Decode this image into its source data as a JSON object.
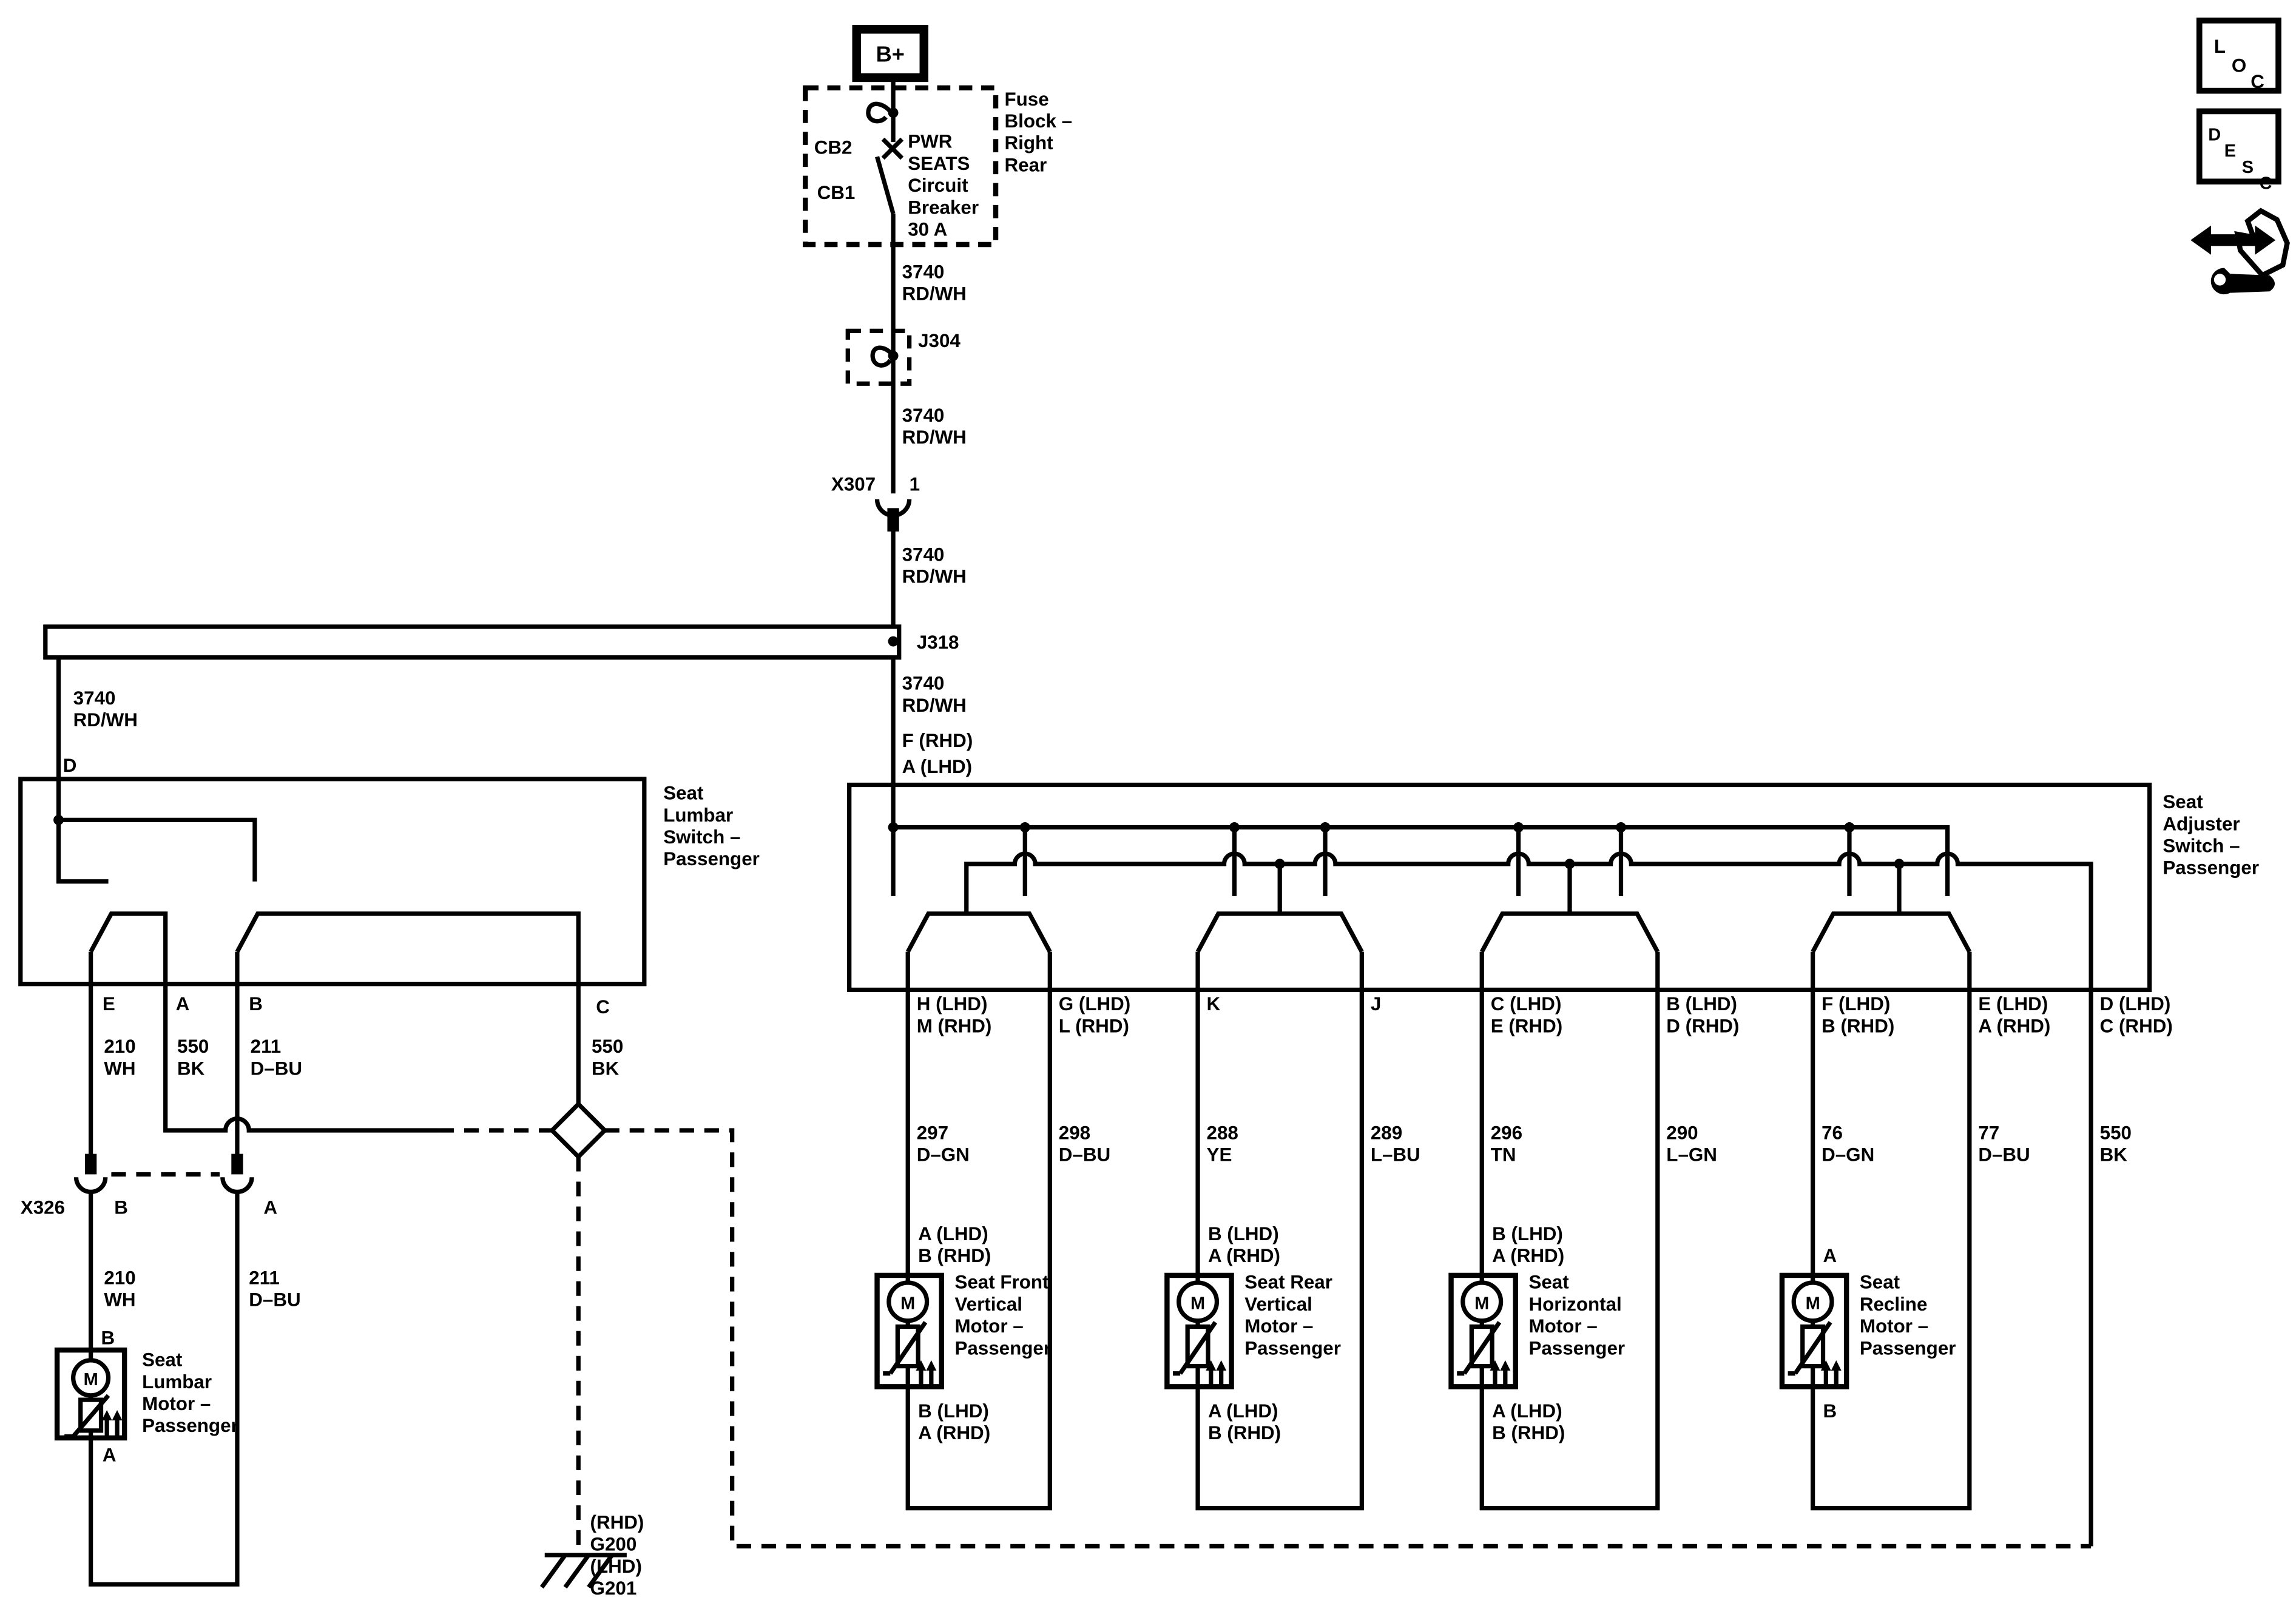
{
  "colors": {
    "ink": "#000000",
    "paper": "#ffffff"
  },
  "labels": {
    "bplus": "B+",
    "fuse_block": [
      "Fuse",
      "Block –",
      "Right",
      "Rear"
    ],
    "cb2": "CB2",
    "cb1": "CB1",
    "breaker": [
      "PWR",
      "SEATS",
      "Circuit",
      "Breaker",
      "30 A"
    ],
    "w3740": [
      "3740",
      "RD/WH"
    ],
    "j304": "J304",
    "x307": "X307",
    "x307_pin": "1",
    "j318": "J318",
    "f_rhd": "F (RHD)",
    "a_lhd": "A (LHD)",
    "pin_d": "D",
    "lumbar_switch": [
      "Seat",
      "Lumbar",
      "Switch –",
      "Passenger"
    ],
    "lumbar_pin_e": "E",
    "lumbar_pin_a": "A",
    "lumbar_pin_b": "B",
    "lumbar_pin_c": "C",
    "w210": [
      "210",
      "WH"
    ],
    "w550": [
      "550",
      "BK"
    ],
    "w211": [
      "211",
      "D–BU"
    ],
    "x326": "X326",
    "x326_b": "B",
    "x326_a": "A",
    "lumbar_motor_top": "B",
    "lumbar_motor_bottom": "A",
    "lumbar_motor": [
      "Seat",
      "Lumbar",
      "Motor –",
      "Passenger"
    ],
    "ground": [
      "(RHD)",
      "G200",
      "(LHD)",
      "G201"
    ],
    "adjuster_switch": [
      "Seat",
      "Adjuster",
      "Switch –",
      "Passenger"
    ],
    "adj_pins": [
      [
        "H (LHD)",
        "M (RHD)"
      ],
      [
        "G (LHD)",
        "L (RHD)"
      ],
      [
        "K"
      ],
      [
        "J"
      ],
      [
        "C (LHD)",
        "E (RHD)"
      ],
      [
        "B (LHD)",
        "D (RHD)"
      ],
      [
        "F (LHD)",
        "B (RHD)"
      ],
      [
        "E (LHD)",
        "A (RHD)"
      ],
      [
        "D (LHD)",
        "C (RHD)"
      ]
    ],
    "adj_wires": [
      [
        "297",
        "D–GN"
      ],
      [
        "298",
        "D–BU"
      ],
      [
        "288",
        "YE"
      ],
      [
        "289",
        "L–BU"
      ],
      [
        "296",
        "TN"
      ],
      [
        "290",
        "L–GN"
      ],
      [
        "76",
        "D–GN"
      ],
      [
        "77",
        "D–BU"
      ],
      [
        "550",
        "BK"
      ]
    ],
    "motor_top": [
      [
        "A (LHD)",
        "B (RHD)"
      ],
      [
        "B (LHD)",
        "A (RHD)"
      ],
      [
        "B (LHD)",
        "A (RHD)"
      ],
      [
        "A"
      ]
    ],
    "motor_bottom": [
      [
        "B (LHD)",
        "A (RHD)"
      ],
      [
        "A (LHD)",
        "B (RHD)"
      ],
      [
        "A (LHD)",
        "B (RHD)"
      ],
      [
        "B"
      ]
    ],
    "motors": [
      [
        "Seat Front",
        "Vertical",
        "Motor –",
        "Passenger"
      ],
      [
        "Seat Rear",
        "Vertical",
        "Motor –",
        "Passenger"
      ],
      [
        "Seat",
        "Horizontal",
        "Motor –",
        "Passenger"
      ],
      [
        "Seat",
        "Recline",
        "Motor –",
        "Passenger"
      ]
    ],
    "motor_m": "M",
    "loc": [
      "L",
      "O",
      "C"
    ],
    "desc": [
      "D",
      "E",
      "S",
      "C"
    ]
  }
}
